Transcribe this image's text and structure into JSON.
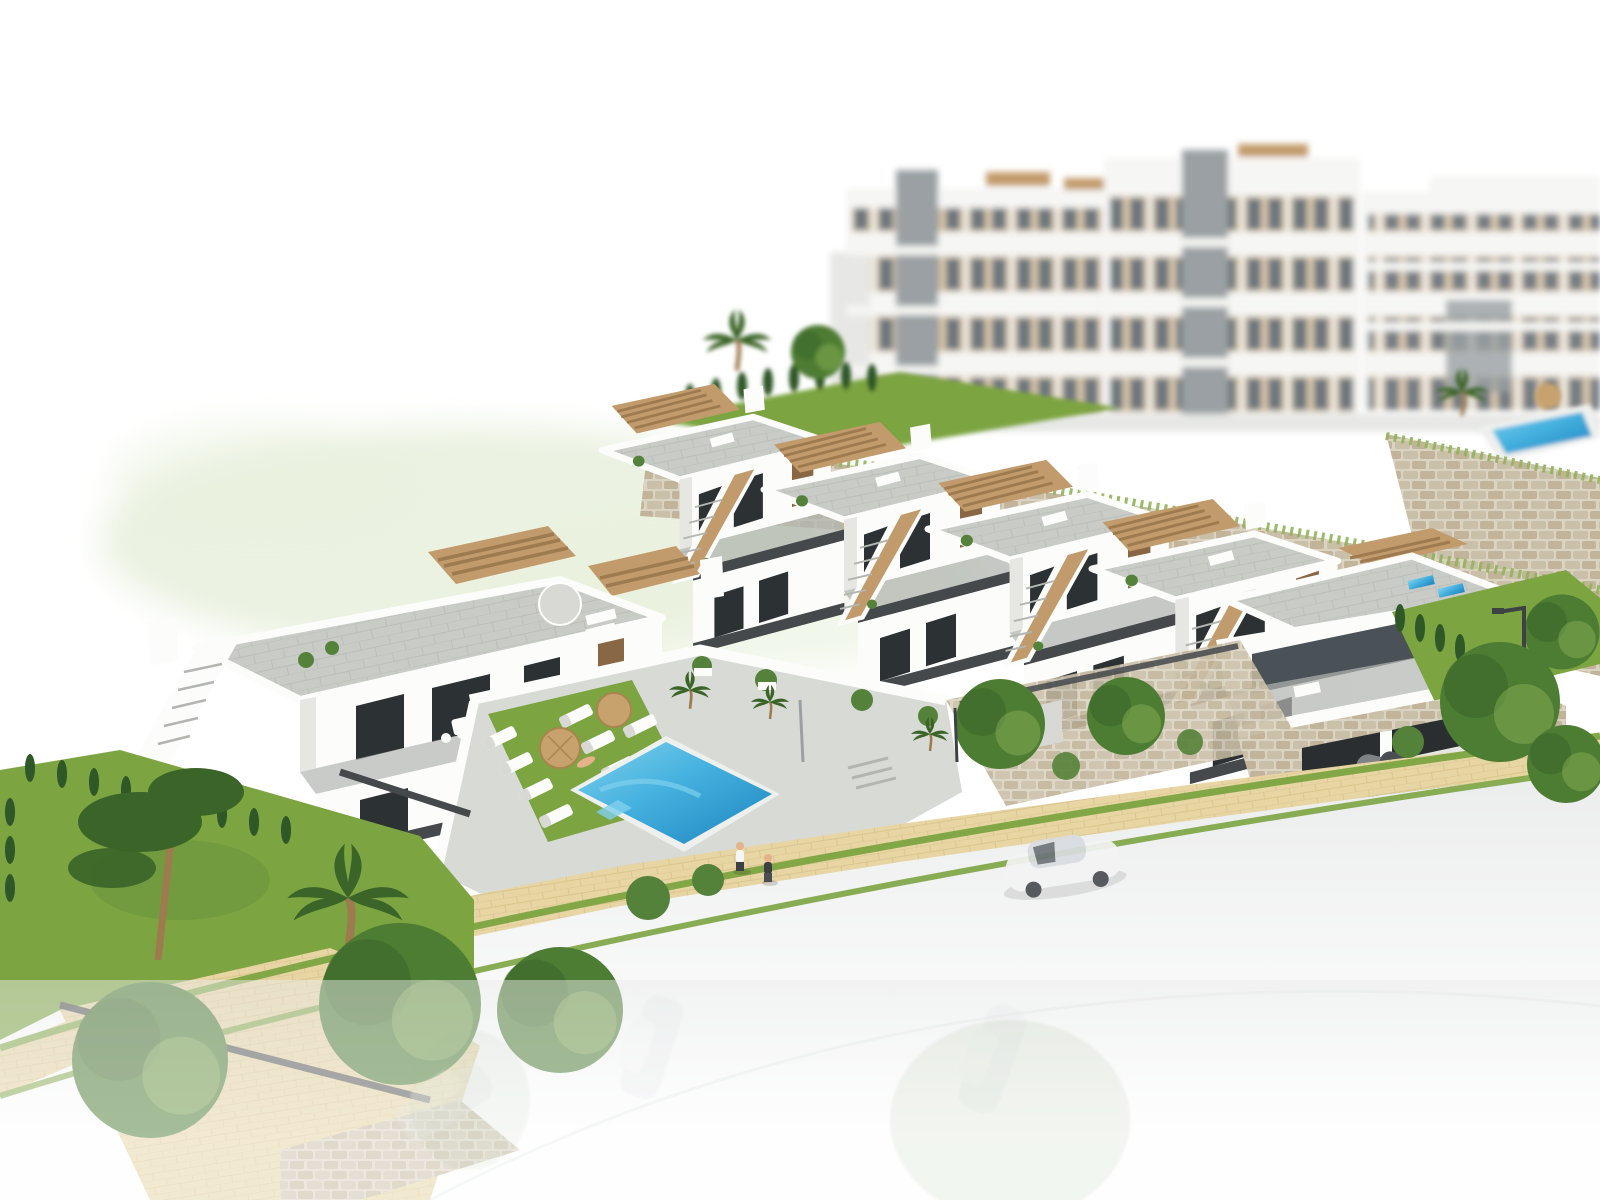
{
  "scene": {
    "type": "architectural-3d-render",
    "description": "Aerial 3D rendering of a modern white hillside residential development: a terraced row of two-storey townhouses with roof terraces, tan wood pergolas and external staircases; a detached two-unit villa on the left; a communal courtyard with rectangular blue swimming pool, white sun loungers and straw parasols; blurred multi-storey apartment blocks behind rubble-stone retaining walls at the top; landscaped gardens with pine, palms and cypress hedges; a sandy pedestrian path along a street with parked cars fading into a white foreground parking area.",
    "background": "pure white cutout with soft green ground haze and depth-of-field blur"
  },
  "palette": {
    "bg": "#ffffff",
    "haze": "#e9f1de",
    "apt_wall": "#f6f6f4",
    "apt_shade": "#e7e8e6",
    "apt_win_beige": "#d8c3a4",
    "apt_glass": "#5d6870",
    "apt_shaft": "#9aa0a3",
    "stone_base": "#dbd3c1",
    "stone_block": "#cabfa8",
    "stone_block2": "#c1b49a",
    "grass": "#7ca441",
    "grass_dark": "#60893a",
    "lawn_light": "#8fb457",
    "tree": "#4d7c33",
    "tree_dark": "#3a6428",
    "cypress": "#2f5727",
    "bush": "#55823a",
    "house_white": "#fcfcfb",
    "house_shade": "#e6e6e3",
    "house_shade2": "#d8d8d4",
    "pav": "#c8cbc6",
    "pav_dark": "#b2b5b0",
    "deck": "#d8dad5",
    "wood": "#c29b6c",
    "wood_dark": "#9e7a4f",
    "door": "#8a6744",
    "glass": "#2c3134",
    "glass_soft": "#4a5257",
    "rail": "#45494c",
    "pool1": "#45b1df",
    "pool2": "#1d85bf",
    "pool_light": "#7fd0ec",
    "coping": "#eef0ee",
    "sand": "#e7d5a3",
    "sand_dark": "#d5bf85",
    "road": "#ebecec",
    "car_white": "#f3f4f3",
    "car_white_shade": "#d9dce0",
    "car_grey": "#7e8285",
    "car_grey_dark": "#4a4e52",
    "lamp": "#3e4245",
    "umbrella": "#c7a26d",
    "umbrella_dark": "#a9854f",
    "skin": "#e5b28c",
    "shirt_white": "#f6f6f5",
    "pants_dark": "#3c4043"
  },
  "objects": {
    "apartment_blocks_background": 3,
    "townhouse_units": 5,
    "villa_units_left": 2,
    "main_pool": 1,
    "background_pool": 1,
    "straw_parasols": 2,
    "roof_parasol_white": 1,
    "sun_loungers_courtyard": 8,
    "cars_white_street": 1,
    "cars_grey_driveway": 1,
    "cars_faded_foreground": 3,
    "people_walking": 2,
    "people_sunbathing": 1,
    "pine_trees": 1,
    "palm_trees": 5,
    "round_trees": 9,
    "street_lamps": 2,
    "stone_retaining_walls": 3
  }
}
